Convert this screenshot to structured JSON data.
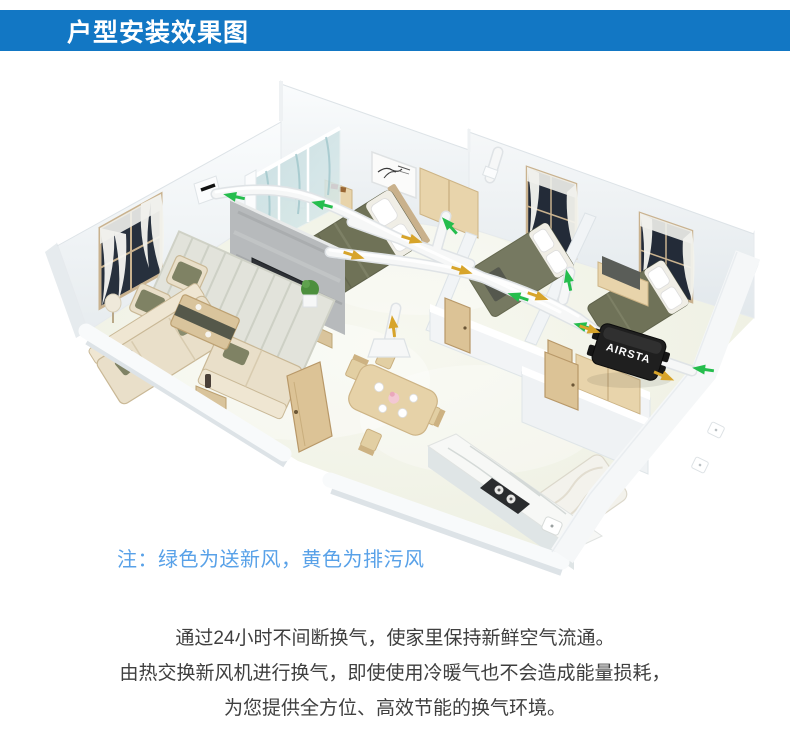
{
  "header": {
    "title": "户型安装效果图",
    "background_color": "#1277c4",
    "text_color": "#ffffff"
  },
  "note": {
    "text": "注：绿色为送新风，黄色为排污风",
    "color": "#58a1e8"
  },
  "description": {
    "color": "#3f3f3f",
    "lines": [
      "通过24小时不间断换气，使家里保持新鲜空气流通。",
      "由热交换新风机进行换气，即使使用冷暖气也不会造成能量损耗，",
      "为您提供全方位、高效节能的换气环境。"
    ]
  },
  "diagram": {
    "unit_label": "AIRSTA",
    "colors": {
      "supply_green": "#25bd4d",
      "exhaust_yellow": "#d7a42a",
      "duct_white": "#f6f7f7",
      "wall_white": "#f6f8f9",
      "floor": "#f2f3ea"
    }
  }
}
